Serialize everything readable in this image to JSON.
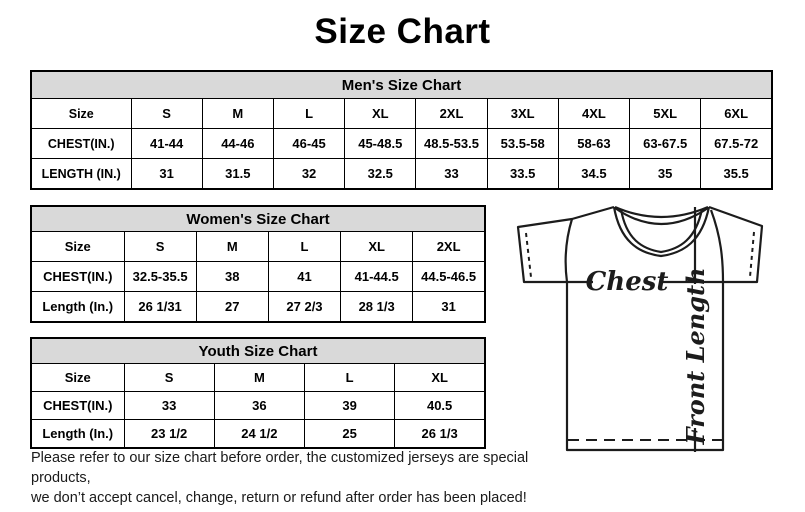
{
  "page": {
    "title": "Size Chart"
  },
  "colors": {
    "header_bg": "#d9d9d9",
    "border": "#000000",
    "text": "#000000"
  },
  "chart_data": [
    {
      "type": "table",
      "title": "Men's Size Chart",
      "corner": "Size",
      "columns": [
        "S",
        "M",
        "L",
        "XL",
        "2XL",
        "3XL",
        "4XL",
        "5XL",
        "6XL"
      ],
      "rows": [
        {
          "label": "CHEST(IN.)",
          "values": [
            "41-44",
            "44-46",
            "46-45",
            "45-48.5",
            "48.5-53.5",
            "53.5-58",
            "58-63",
            "63-67.5",
            "67.5-72"
          ]
        },
        {
          "label": "LENGTH (IN.)",
          "values": [
            "31",
            "31.5",
            "32",
            "32.5",
            "33",
            "33.5",
            "34.5",
            "35",
            "35.5"
          ]
        }
      ]
    },
    {
      "type": "table",
      "title": "Women's Size Chart",
      "corner": "Size",
      "columns": [
        "S",
        "M",
        "L",
        "XL",
        "2XL"
      ],
      "rows": [
        {
          "label": "CHEST(IN.)",
          "values": [
            "32.5-35.5",
            "38",
            "41",
            "41-44.5",
            "44.5-46.5"
          ]
        },
        {
          "label": "Length (In.)",
          "values": [
            "26 1/31",
            "27",
            "27 2/3",
            "28 1/3",
            "31"
          ]
        }
      ]
    },
    {
      "type": "table",
      "title": "Youth Size Chart",
      "corner": "Size",
      "columns": [
        "S",
        "M",
        "L",
        "XL"
      ],
      "rows": [
        {
          "label": "CHEST(IN.)",
          "values": [
            "33",
            "36",
            "39",
            "40.5"
          ]
        },
        {
          "label": "Length (In.)",
          "values": [
            "23 1/2",
            "24 1/2",
            "25",
            "26 1/3"
          ]
        }
      ]
    }
  ],
  "diagram": {
    "chest_label": "Chest",
    "front_length_label": "Front Length"
  },
  "footer": {
    "line1": "Please refer to our size chart before order, the customized jerseys are special products,",
    "line2": "we don’t accept cancel, change, return or refund after order has been placed!"
  }
}
